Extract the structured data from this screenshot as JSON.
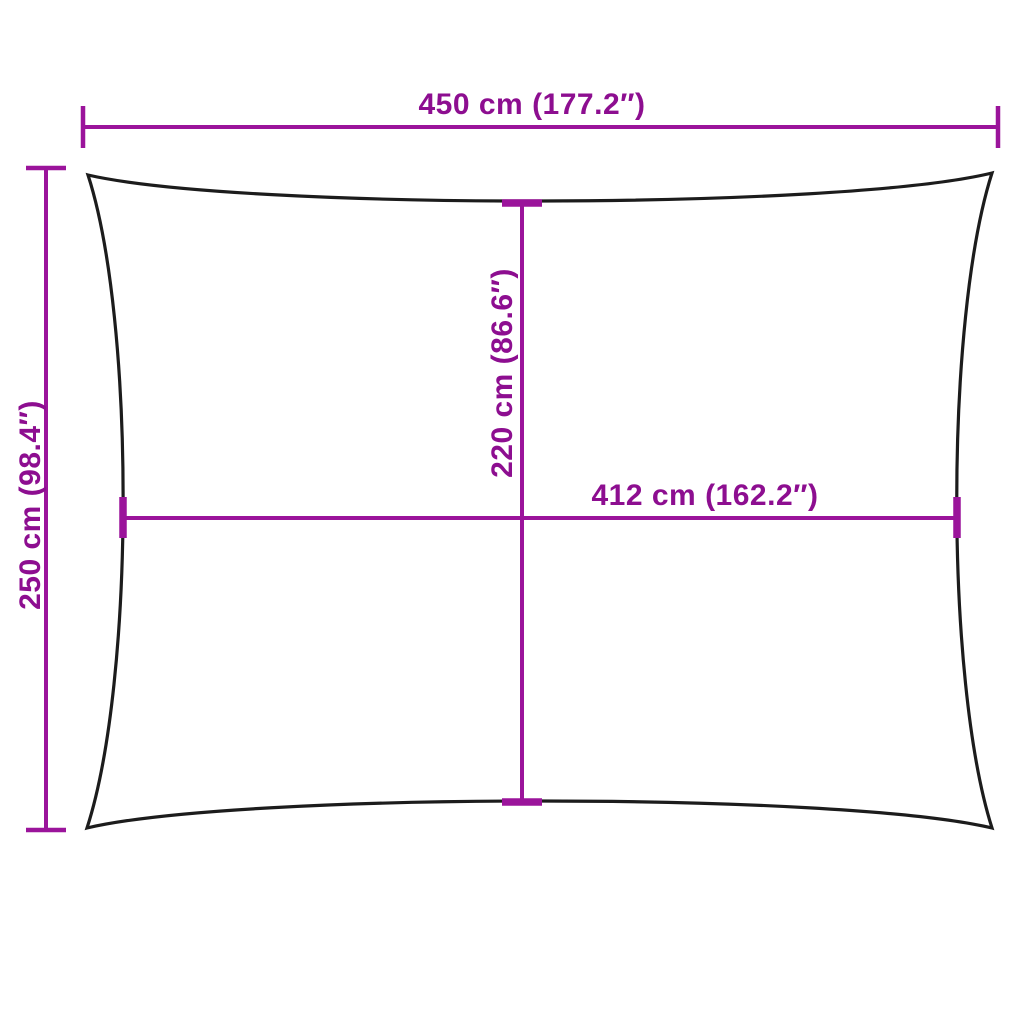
{
  "figure": {
    "type": "product-dimension-diagram",
    "subject": "rectangular shade sail outline with concave edges",
    "labels": {
      "overall_width": "450 cm (177.2″)",
      "overall_height": "250 cm (98.4″)",
      "inner_vertical": "220 cm (86.6″)",
      "inner_horizontal": "412 cm (162.2″)"
    },
    "measurements": {
      "overall_width_cm": 450,
      "overall_width_in": 177.2,
      "overall_height_cm": 250,
      "overall_height_in": 98.4,
      "inner_vertical_cm": 220,
      "inner_vertical_in": 86.6,
      "inner_horizontal_cm": 412,
      "inner_horizontal_in": 162.2
    },
    "colors": {
      "dimension_lines": "#9b149b",
      "dimension_text": "#8d0e90",
      "outline": "#1c1c1c",
      "background": "#ffffff"
    }
  }
}
